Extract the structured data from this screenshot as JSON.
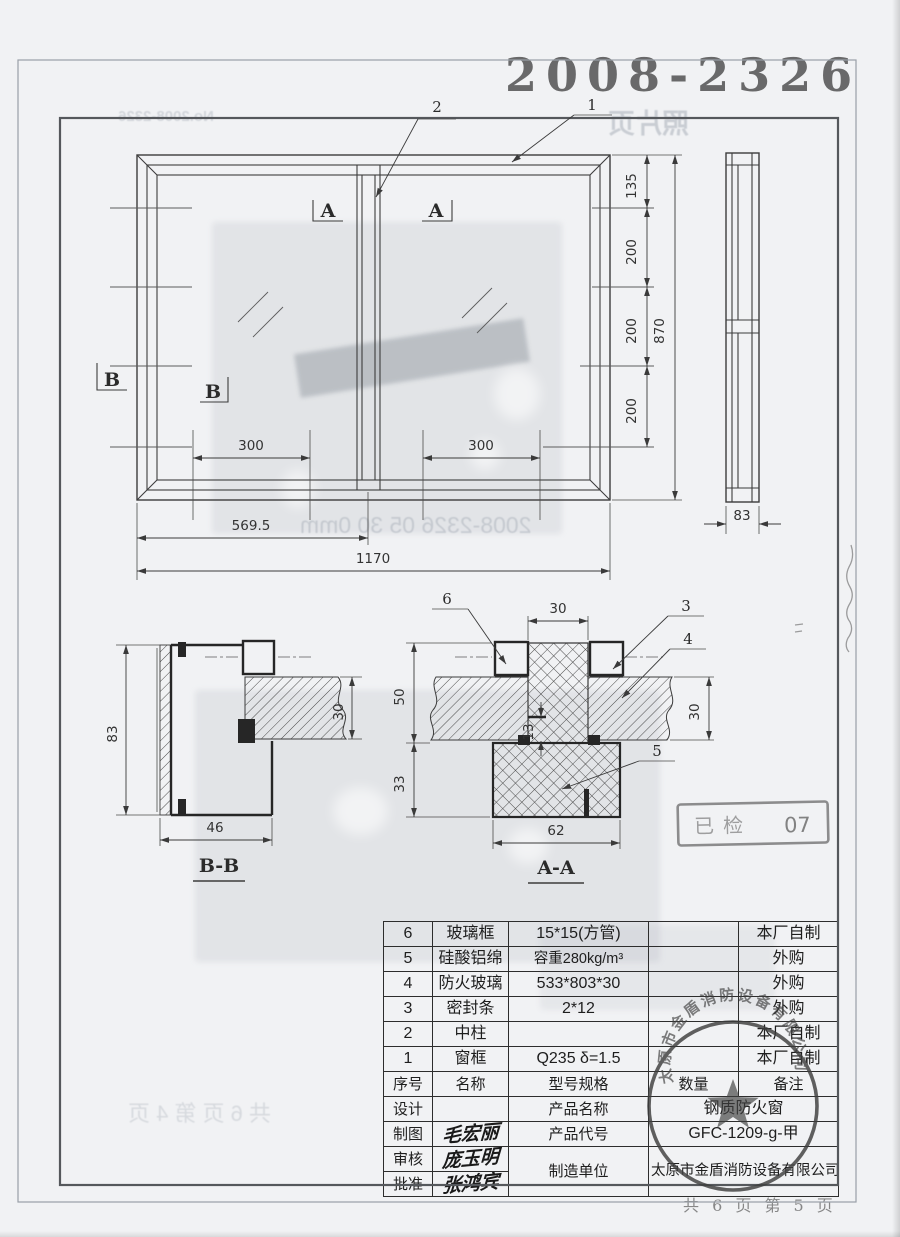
{
  "page": {
    "doc_number": "2008-2326",
    "footer_page_info": "共 6 页 第 5 页",
    "stamps": {
      "inspection_text": "已检",
      "inspection_number": "07",
      "company_seal": "太原市金盾消防设备有限公司"
    },
    "bleed_through": {
      "doc_no_mirrored": "No.2008-2326",
      "photo_page_mirrored": "照片页",
      "footer_mirrored": "共 6 页 第 4 页",
      "photo_caption_mirrored": "2008-2326  05 30  0mm"
    }
  },
  "drawing": {
    "front_view": {
      "callouts": {
        "c1": "1",
        "c2": "2"
      },
      "section_marks": {
        "a": "A",
        "b": "B"
      },
      "dims": {
        "overall_width": "1170",
        "left_half_width": "569.5",
        "pane_left": "300",
        "pane_right": "300",
        "overall_height": "870",
        "seg_top": "135",
        "seg_2": "200",
        "seg_3": "200",
        "seg_4": "200"
      }
    },
    "side_view": {
      "dims": {
        "depth": "83"
      }
    },
    "section_bb": {
      "label": "B-B",
      "dims": {
        "height": "83",
        "width": "46",
        "glass_thickness": "30"
      }
    },
    "section_aa": {
      "label": "A-A",
      "callouts": {
        "c3": "3",
        "c4": "4",
        "c5": "5",
        "c6": "6"
      },
      "dims": {
        "mullion_width": "30",
        "upper_height": "50",
        "lower_height": "33",
        "inner_step": "13",
        "glass_thickness": "30",
        "base_width": "62"
      }
    }
  },
  "bom": {
    "headers": {
      "seq": "序号",
      "name": "名称",
      "spec": "型号规格",
      "qty": "数量",
      "remark": "备注"
    },
    "rows": [
      {
        "seq": "6",
        "name": "玻璃框",
        "spec": "15*15(方管)",
        "qty": "",
        "remark": "本厂自制"
      },
      {
        "seq": "5",
        "name": "硅酸铝绵",
        "spec": "容重280kg/m³",
        "qty": "",
        "remark": "外购"
      },
      {
        "seq": "4",
        "name": "防火玻璃",
        "spec": "533*803*30",
        "qty": "",
        "remark": "外购"
      },
      {
        "seq": "3",
        "name": "密封条",
        "spec": "2*12",
        "qty": "",
        "remark": "外购"
      },
      {
        "seq": "2",
        "name": "中柱",
        "spec": "",
        "qty": "",
        "remark": "本厂自制"
      },
      {
        "seq": "1",
        "name": "窗框",
        "spec": "Q235  δ=1.5",
        "qty": "",
        "remark": "本厂自制"
      }
    ]
  },
  "title_block": {
    "design_label": "设计",
    "draft_label": "制图",
    "review_label": "审核",
    "approve_label": "批准",
    "draft_signature": "毛宏丽",
    "review_signature": "庞玉明",
    "approve_signature": "张鸿宾",
    "product_name_label": "产品名称",
    "product_name": "钢质防火窗",
    "product_code_label": "产品代号",
    "product_code": "GFC-1209-g-甲",
    "manufacturer_label": "制造单位",
    "manufacturer": "太原市金盾消防设备有限公司"
  }
}
